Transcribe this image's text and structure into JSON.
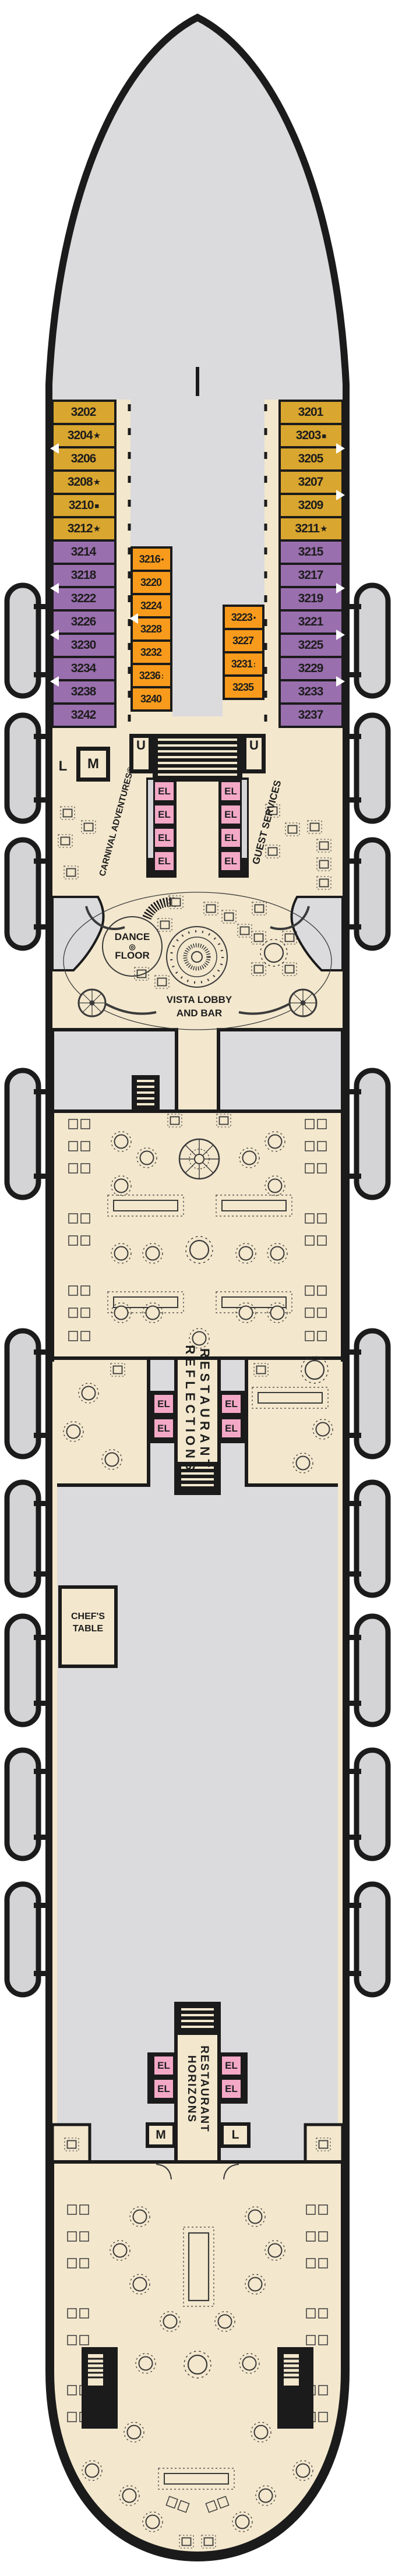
{
  "colors": {
    "gold": "#D9A62F",
    "purple": "#9A6FAE",
    "orange": "#F89B1C",
    "elevator_pink": "#F3A9C6",
    "floor_cream": "#F3E7CD",
    "void_gray": "#DBDBDD",
    "outline_ink": "#1B1B1B"
  },
  "labels": {
    "u_label": "U",
    "m_label": "M",
    "l_label": "L",
    "elevator": "EL",
    "carnival_adventures": "CARNIVAL ADVENTURES®",
    "guest_services": "GUEST SERVICES",
    "dance_floor_line1": "DANCE",
    "dance_floor_icon": "◎",
    "dance_floor_line2": "FLOOR",
    "vista_lobby_line1": "VISTA LOBBY",
    "vista_lobby_line2": "AND BAR",
    "reflections_word1": "REFLECTIONS",
    "reflections_word2": "RESTAURANT",
    "horizons_word1": "HORIZONS",
    "horizons_word2": "RESTAURANT",
    "chefs_table_line1": "CHEF'S",
    "chefs_table_line2": "TABLE"
  },
  "cabins": {
    "port_outer": [
      {
        "n": "3202",
        "s": "",
        "cls": "gold"
      },
      {
        "n": "3204",
        "s": "★",
        "cls": "gold door"
      },
      {
        "n": "3206",
        "s": "",
        "cls": "gold"
      },
      {
        "n": "3208",
        "s": "★",
        "cls": "gold"
      },
      {
        "n": "3210",
        "s": "■",
        "cls": "gold"
      },
      {
        "n": "3212",
        "s": "★",
        "cls": "gold"
      },
      {
        "n": "3214",
        "s": "",
        "cls": "purple"
      },
      {
        "n": "3218",
        "s": "",
        "cls": "purple door"
      },
      {
        "n": "3222",
        "s": "",
        "cls": "purple"
      },
      {
        "n": "3226",
        "s": "",
        "cls": "purple door"
      },
      {
        "n": "3230",
        "s": "",
        "cls": "purple"
      },
      {
        "n": "3234",
        "s": "",
        "cls": "purple door"
      },
      {
        "n": "3238",
        "s": "",
        "cls": "purple"
      },
      {
        "n": "3242",
        "s": "",
        "cls": "purple"
      }
    ],
    "port_inner": [
      {
        "n": "3216",
        "s": "•",
        "cls": "orange"
      },
      {
        "n": "3220",
        "s": "",
        "cls": "orange"
      },
      {
        "n": "3224",
        "s": "",
        "cls": "orange door"
      },
      {
        "n": "3228",
        "s": "",
        "cls": "orange"
      },
      {
        "n": "3232",
        "s": "",
        "cls": "orange"
      },
      {
        "n": "3236",
        "s": ":",
        "cls": "orange"
      },
      {
        "n": "3240",
        "s": "",
        "cls": "orange"
      }
    ],
    "stbd_outer": [
      {
        "n": "3201",
        "s": "",
        "cls": "gold"
      },
      {
        "n": "3203",
        "s": "■",
        "cls": "gold door"
      },
      {
        "n": "3205",
        "s": "",
        "cls": "gold"
      },
      {
        "n": "3207",
        "s": "",
        "cls": "gold door"
      },
      {
        "n": "3209",
        "s": "",
        "cls": "gold"
      },
      {
        "n": "3211",
        "s": "★",
        "cls": "gold"
      },
      {
        "n": "3215",
        "s": "",
        "cls": "purple"
      },
      {
        "n": "3217",
        "s": "",
        "cls": "purple door"
      },
      {
        "n": "3219",
        "s": "",
        "cls": "purple"
      },
      {
        "n": "3221",
        "s": "",
        "cls": "purple door"
      },
      {
        "n": "3225",
        "s": "",
        "cls": "purple"
      },
      {
        "n": "3229",
        "s": "",
        "cls": "purple door"
      },
      {
        "n": "3233",
        "s": "",
        "cls": "purple"
      },
      {
        "n": "3237",
        "s": "",
        "cls": "purple"
      }
    ],
    "stbd_inner": [
      {
        "n": "3223",
        "s": "•",
        "cls": "orange"
      },
      {
        "n": "3227",
        "s": "",
        "cls": "orange"
      },
      {
        "n": "3231",
        "s": ":",
        "cls": "orange"
      },
      {
        "n": "3235",
        "s": "",
        "cls": "orange"
      }
    ]
  }
}
